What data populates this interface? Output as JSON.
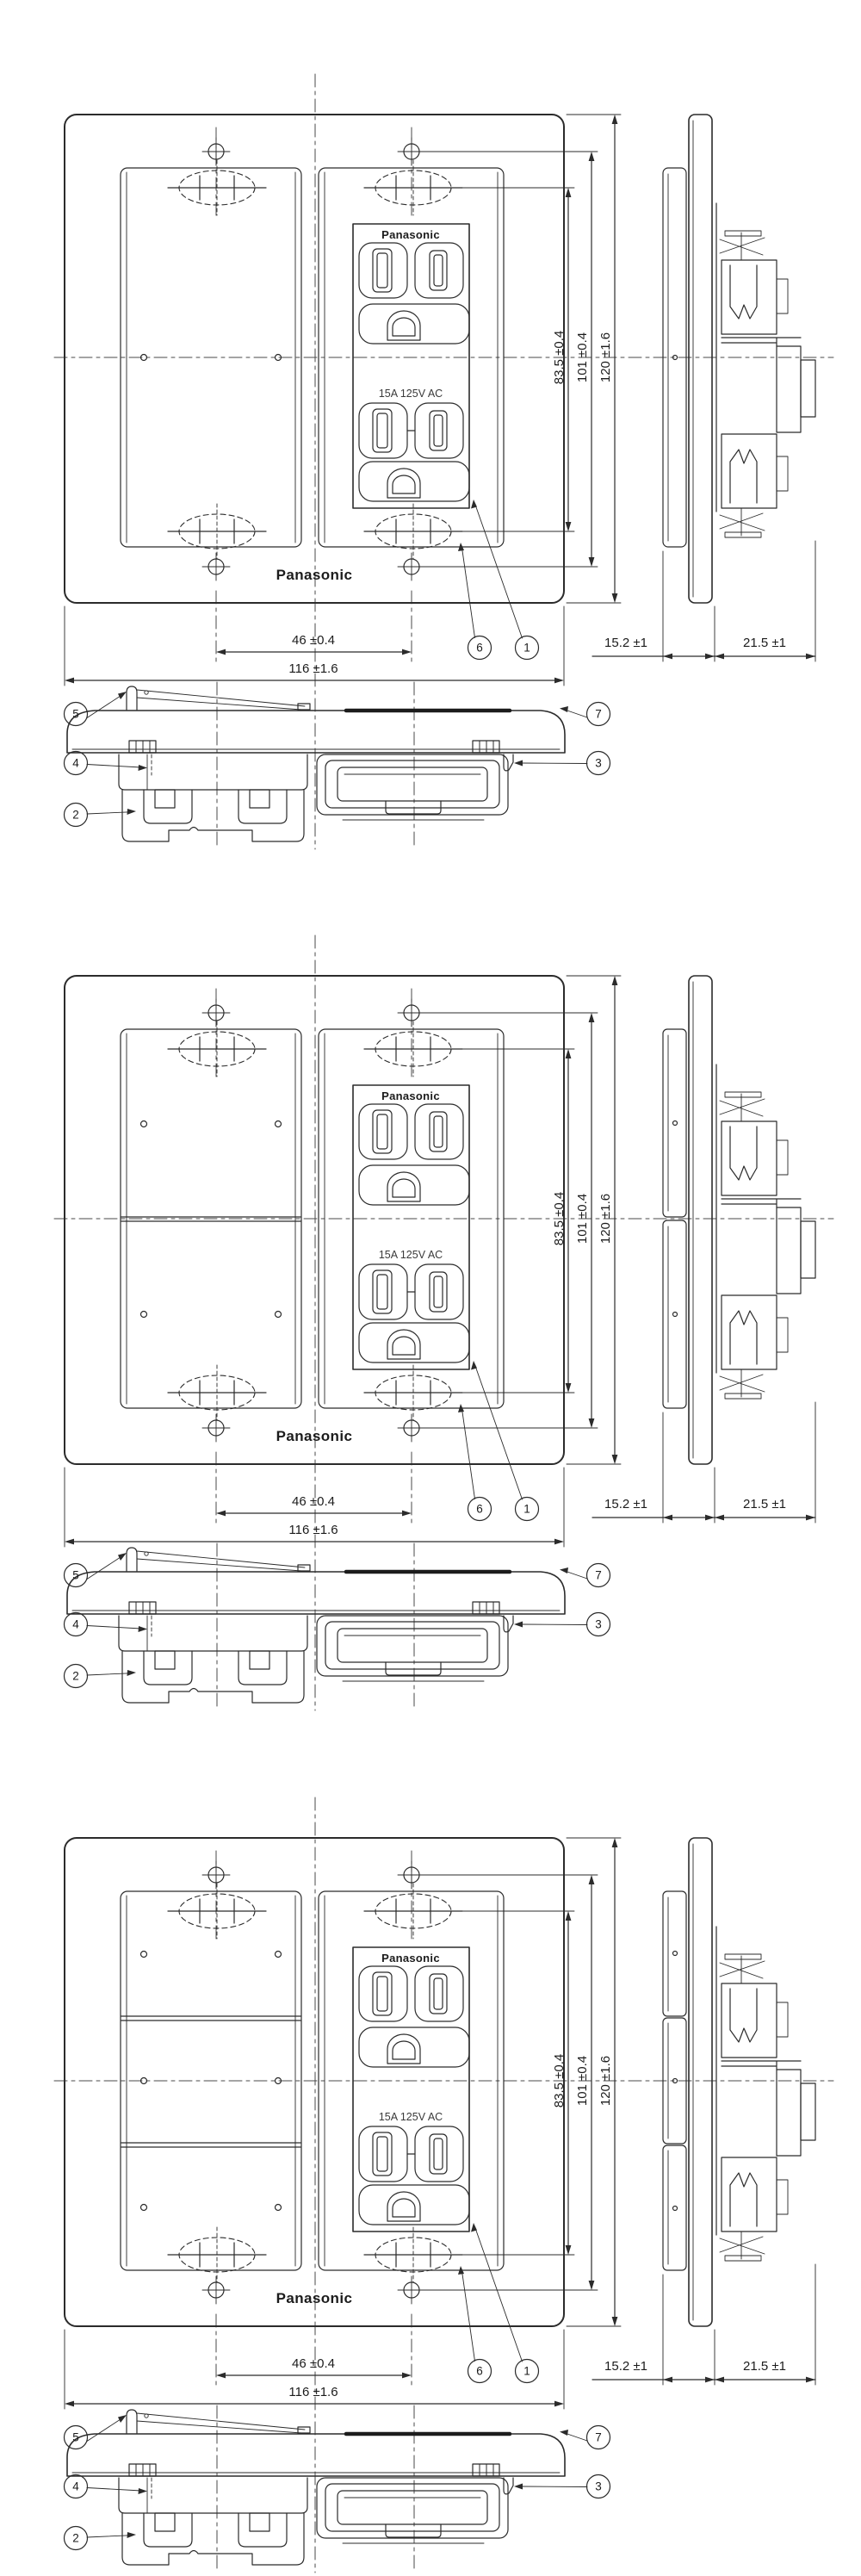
{
  "drawing": {
    "title": "Panasonic outlet plate dimension drawing",
    "line_color": "#2b2b2b",
    "background": "#ffffff",
    "plate_brand": "Panasonic",
    "outlet_brand": "Panasonic",
    "rating": "15A 125V AC",
    "dimensions": {
      "outlet_slot_height": "83.5 ±0.4",
      "screw_pitch_height": "101 ±0.4",
      "plate_height": "120 ±1.6",
      "screw_pitch_width": "46 ±0.4",
      "plate_width": "116 ±1.6",
      "plate_depth": "15.2 ±1",
      "body_depth": "21.5 ±1"
    },
    "callouts": {
      "c1": "1",
      "c2": "2",
      "c3": "3",
      "c4": "4",
      "c5": "5",
      "c6": "6",
      "c7": "7"
    },
    "groups": [
      {
        "variant": "1",
        "name": "drawing-group-1-single-cover"
      },
      {
        "variant": "2",
        "name": "drawing-group-2-two-section-cover"
      },
      {
        "variant": "3",
        "name": "drawing-group-3-three-section-cover"
      }
    ]
  }
}
